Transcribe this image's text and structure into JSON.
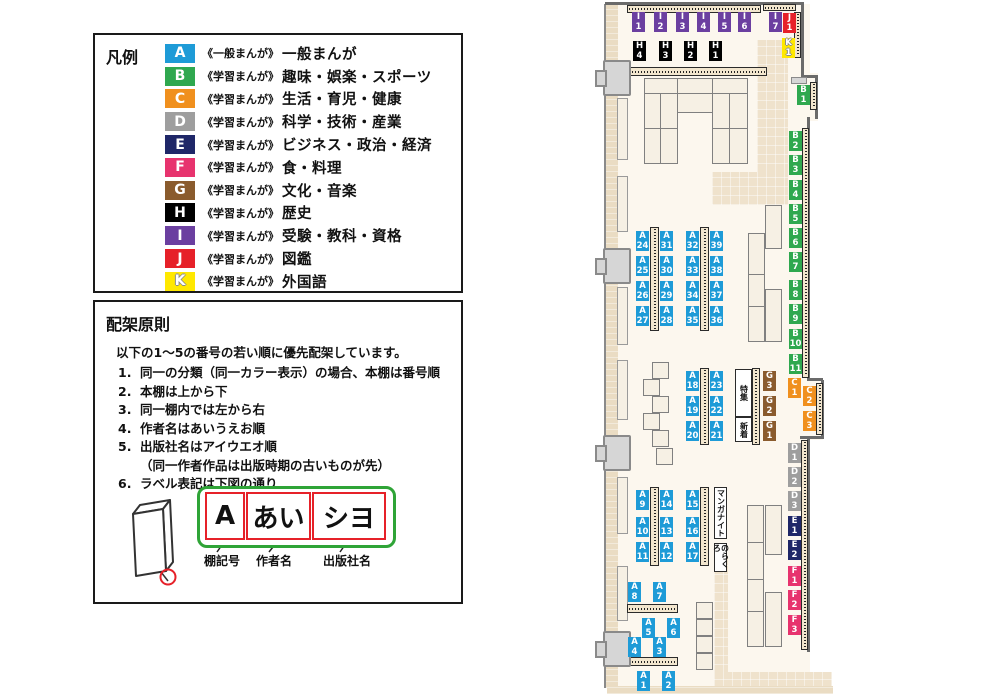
{
  "colors": {
    "A": "#1E9BD7",
    "B": "#2FA84F",
    "C": "#F0901E",
    "D": "#9E9E9E",
    "E": "#1F2768",
    "F": "#E7336E",
    "G": "#8A5B2D",
    "H": "#000000",
    "I": "#6B3FA0",
    "J": "#E62129",
    "K": "#FFE800"
  },
  "legend": {
    "title": "凡例",
    "items": [
      {
        "code": "A",
        "series": "《一般まんが》",
        "label": "一般まんが"
      },
      {
        "code": "B",
        "series": "《学習まんが》",
        "label": "趣味・娯楽・スポーツ"
      },
      {
        "code": "C",
        "series": "《学習まんが》",
        "label": "生活・育児・健康"
      },
      {
        "code": "D",
        "series": "《学習まんが》",
        "label": "科学・技術・産業"
      },
      {
        "code": "E",
        "series": "《学習まんが》",
        "label": "ビジネス・政治・経済"
      },
      {
        "code": "F",
        "series": "《学習まんが》",
        "label": "食・料理"
      },
      {
        "code": "G",
        "series": "《学習まんが》",
        "label": "文化・音楽"
      },
      {
        "code": "H",
        "series": "《学習まんが》",
        "label": "歴史"
      },
      {
        "code": "I",
        "series": "《学習まんが》",
        "label": "受験・教科・資格"
      },
      {
        "code": "J",
        "series": "《学習まんが》",
        "label": "図鑑"
      },
      {
        "code": "K",
        "series": "《学習まんが》",
        "label": "外国語"
      }
    ]
  },
  "principles": {
    "title": "配架原則",
    "intro": "以下の1～5の番号の若い順に優先配架しています。",
    "rules": [
      {
        "num": "1.",
        "text": "同一の分類（同一カラー表示）の場合、本棚は番号順"
      },
      {
        "num": "2.",
        "text": "本棚は上から下"
      },
      {
        "num": "3.",
        "text": "同一棚内では左から右"
      },
      {
        "num": "4.",
        "text": "作者名はあいうえお順"
      },
      {
        "num": "5.",
        "text": "出版社名はアイウエオ順",
        "note": "（同一作者作品は出版時期の古いものが先）"
      },
      {
        "num": "6.",
        "text": "ラベル表記は下図の通り"
      }
    ],
    "label_diagram": {
      "segments": [
        {
          "text": "A",
          "caption": "棚記号"
        },
        {
          "text": "あい",
          "caption": "作者名"
        },
        {
          "text": "シヨ",
          "caption": "出版社名"
        }
      ]
    }
  },
  "map": {
    "labels": [
      {
        "t": "I\n1",
        "k": "I",
        "x": 632,
        "y": 12
      },
      {
        "t": "I\n2",
        "k": "I",
        "x": 654,
        "y": 12
      },
      {
        "t": "I\n3",
        "k": "I",
        "x": 676,
        "y": 12
      },
      {
        "t": "I\n4",
        "k": "I",
        "x": 697,
        "y": 12
      },
      {
        "t": "I\n5",
        "k": "I",
        "x": 718,
        "y": 12
      },
      {
        "t": "I\n6",
        "k": "I",
        "x": 738,
        "y": 12
      },
      {
        "t": "I\n7",
        "k": "I",
        "x": 769,
        "y": 12
      },
      {
        "t": "J\n1",
        "k": "J",
        "x": 783,
        "y": 13
      },
      {
        "t": "K\n1",
        "k": "K",
        "x": 782,
        "y": 38
      },
      {
        "t": "H\n4",
        "k": "H",
        "x": 633,
        "y": 41
      },
      {
        "t": "H\n3",
        "k": "H",
        "x": 659,
        "y": 41
      },
      {
        "t": "H\n2",
        "k": "H",
        "x": 684,
        "y": 41
      },
      {
        "t": "H\n1",
        "k": "H",
        "x": 709,
        "y": 41
      },
      {
        "t": "B\n1",
        "k": "B",
        "x": 797,
        "y": 85
      },
      {
        "t": "B\n2",
        "k": "B",
        "x": 789,
        "y": 131
      },
      {
        "t": "B\n3",
        "k": "B",
        "x": 789,
        "y": 155
      },
      {
        "t": "B\n4",
        "k": "B",
        "x": 789,
        "y": 180
      },
      {
        "t": "B\n5",
        "k": "B",
        "x": 789,
        "y": 204
      },
      {
        "t": "B\n6",
        "k": "B",
        "x": 789,
        "y": 228
      },
      {
        "t": "B\n7",
        "k": "B",
        "x": 789,
        "y": 252
      },
      {
        "t": "B\n8",
        "k": "B",
        "x": 789,
        "y": 280
      },
      {
        "t": "B\n9",
        "k": "B",
        "x": 789,
        "y": 304
      },
      {
        "t": "B\n10",
        "k": "B",
        "x": 789,
        "y": 329
      },
      {
        "t": "B\n11",
        "k": "B",
        "x": 789,
        "y": 354
      },
      {
        "t": "C\n1",
        "k": "C",
        "x": 788,
        "y": 378
      },
      {
        "t": "C\n2",
        "k": "C",
        "x": 803,
        "y": 386
      },
      {
        "t": "C\n3",
        "k": "C",
        "x": 803,
        "y": 411
      },
      {
        "t": "D\n1",
        "k": "D",
        "x": 788,
        "y": 443
      },
      {
        "t": "D\n2",
        "k": "D",
        "x": 788,
        "y": 467
      },
      {
        "t": "D\n3",
        "k": "D",
        "x": 788,
        "y": 491
      },
      {
        "t": "E\n1",
        "k": "E",
        "x": 788,
        "y": 516
      },
      {
        "t": "E\n2",
        "k": "E",
        "x": 788,
        "y": 540
      },
      {
        "t": "F\n1",
        "k": "F",
        "x": 788,
        "y": 566
      },
      {
        "t": "F\n2",
        "k": "F",
        "x": 788,
        "y": 590
      },
      {
        "t": "F\n3",
        "k": "F",
        "x": 788,
        "y": 615
      },
      {
        "t": "G\n3",
        "k": "G",
        "x": 763,
        "y": 371
      },
      {
        "t": "G\n2",
        "k": "G",
        "x": 763,
        "y": 396
      },
      {
        "t": "G\n1",
        "k": "G",
        "x": 763,
        "y": 421
      },
      {
        "t": "A\n24",
        "k": "A",
        "x": 636,
        "y": 231
      },
      {
        "t": "A\n31",
        "k": "A",
        "x": 660,
        "y": 231
      },
      {
        "t": "A\n25",
        "k": "A",
        "x": 636,
        "y": 256
      },
      {
        "t": "A\n30",
        "k": "A",
        "x": 660,
        "y": 256
      },
      {
        "t": "A\n26",
        "k": "A",
        "x": 636,
        "y": 281
      },
      {
        "t": "A\n29",
        "k": "A",
        "x": 660,
        "y": 281
      },
      {
        "t": "A\n27",
        "k": "A",
        "x": 636,
        "y": 306
      },
      {
        "t": "A\n28",
        "k": "A",
        "x": 660,
        "y": 306
      },
      {
        "t": "A\n32",
        "k": "A",
        "x": 686,
        "y": 231
      },
      {
        "t": "A\n39",
        "k": "A",
        "x": 710,
        "y": 231
      },
      {
        "t": "A\n33",
        "k": "A",
        "x": 686,
        "y": 256
      },
      {
        "t": "A\n38",
        "k": "A",
        "x": 710,
        "y": 256
      },
      {
        "t": "A\n34",
        "k": "A",
        "x": 686,
        "y": 281
      },
      {
        "t": "A\n37",
        "k": "A",
        "x": 710,
        "y": 281
      },
      {
        "t": "A\n35",
        "k": "A",
        "x": 686,
        "y": 306
      },
      {
        "t": "A\n36",
        "k": "A",
        "x": 710,
        "y": 306
      },
      {
        "t": "A\n18",
        "k": "A",
        "x": 686,
        "y": 371
      },
      {
        "t": "A\n23",
        "k": "A",
        "x": 710,
        "y": 371
      },
      {
        "t": "A\n19",
        "k": "A",
        "x": 686,
        "y": 396
      },
      {
        "t": "A\n22",
        "k": "A",
        "x": 710,
        "y": 396
      },
      {
        "t": "A\n20",
        "k": "A",
        "x": 686,
        "y": 421
      },
      {
        "t": "A\n21",
        "k": "A",
        "x": 710,
        "y": 421
      },
      {
        "t": "A\n9",
        "k": "A",
        "x": 636,
        "y": 490
      },
      {
        "t": "A\n14",
        "k": "A",
        "x": 660,
        "y": 490
      },
      {
        "t": "A\n10",
        "k": "A",
        "x": 636,
        "y": 517
      },
      {
        "t": "A\n13",
        "k": "A",
        "x": 660,
        "y": 517
      },
      {
        "t": "A\n11",
        "k": "A",
        "x": 636,
        "y": 542
      },
      {
        "t": "A\n12",
        "k": "A",
        "x": 660,
        "y": 542
      },
      {
        "t": "A\n15",
        "k": "A",
        "x": 686,
        "y": 490
      },
      {
        "t": "A\n16",
        "k": "A",
        "x": 686,
        "y": 517
      },
      {
        "t": "A\n17",
        "k": "A",
        "x": 686,
        "y": 542
      },
      {
        "t": "A\n8",
        "k": "A",
        "x": 628,
        "y": 582
      },
      {
        "t": "A\n7",
        "k": "A",
        "x": 653,
        "y": 582
      },
      {
        "t": "A\n5",
        "k": "A",
        "x": 642,
        "y": 618
      },
      {
        "t": "A\n6",
        "k": "A",
        "x": 667,
        "y": 618
      },
      {
        "t": "A\n4",
        "k": "A",
        "x": 628,
        "y": 637
      },
      {
        "t": "A\n3",
        "k": "A",
        "x": 653,
        "y": 637
      },
      {
        "t": "A\n1",
        "k": "A",
        "x": 637,
        "y": 671
      },
      {
        "t": "A\n2",
        "k": "A",
        "x": 662,
        "y": 671
      }
    ],
    "annotations": [
      {
        "text": "特集",
        "x": 735,
        "y": 369,
        "w": 17,
        "h": 48
      },
      {
        "text": "新着",
        "x": 735,
        "y": 417,
        "w": 17,
        "h": 25
      },
      {
        "text": "マンガナイト",
        "x": 714,
        "y": 487,
        "w": 13,
        "h": 52
      },
      {
        "text": "のらくろ",
        "x": 714,
        "y": 543,
        "w": 13,
        "h": 29
      }
    ]
  }
}
